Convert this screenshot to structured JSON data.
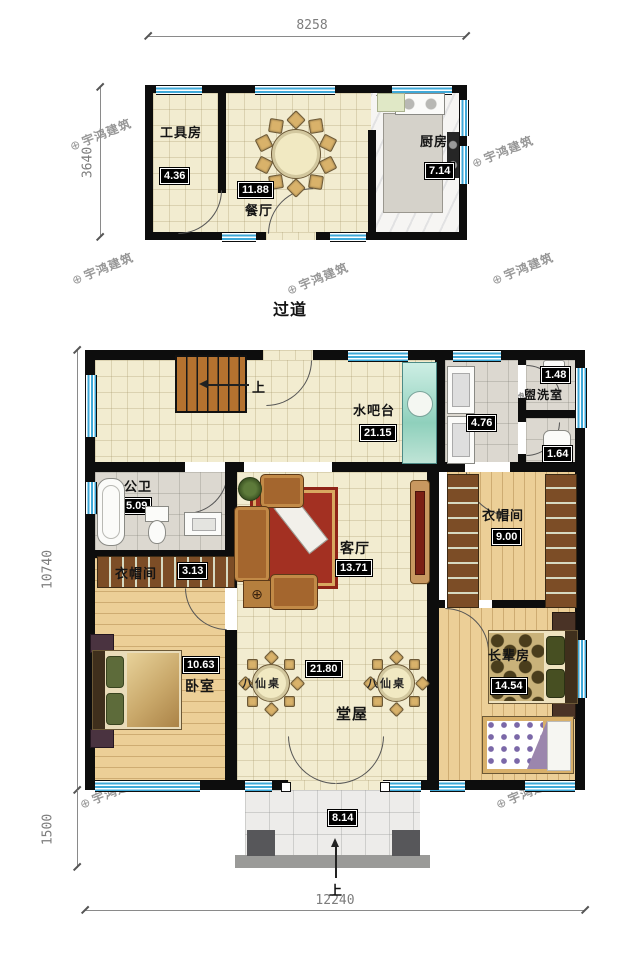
{
  "watermark": {
    "logo": "⊕",
    "text": "宇鸿建筑"
  },
  "corridor_label": "过道",
  "upper_plan": {
    "dim_top": "8258",
    "dim_left": "3640",
    "rooms": [
      {
        "name": "工具房",
        "area": "4.36"
      },
      {
        "name": "餐厅",
        "area": "11.88"
      },
      {
        "name": "厨房",
        "area": "7.14"
      }
    ]
  },
  "lower_plan": {
    "dim_left_main": "10740",
    "dim_left_porch": "1500",
    "dim_bottom": "12240",
    "stairs_up": "上",
    "entry_up": "上",
    "tables": [
      "八仙桌",
      "八仙桌"
    ],
    "rooms": [
      {
        "name": "水吧台",
        "area": "21.15"
      },
      {
        "name": "",
        "area": "4.76"
      },
      {
        "name": "盥洗室",
        "area": "1.48"
      },
      {
        "name": "",
        "area": "1.64"
      },
      {
        "name": "公卫",
        "area": "5.09"
      },
      {
        "name": "衣帽间",
        "area": "3.13"
      },
      {
        "name": "客厅",
        "area": "13.71"
      },
      {
        "name": "衣帽间",
        "area": "9.00"
      },
      {
        "name": "卧室",
        "area": "10.63"
      },
      {
        "name": "堂屋",
        "area": "21.80"
      },
      {
        "name": "长辈房",
        "area": "14.54"
      },
      {
        "name": "",
        "area": "8.14"
      }
    ]
  }
}
